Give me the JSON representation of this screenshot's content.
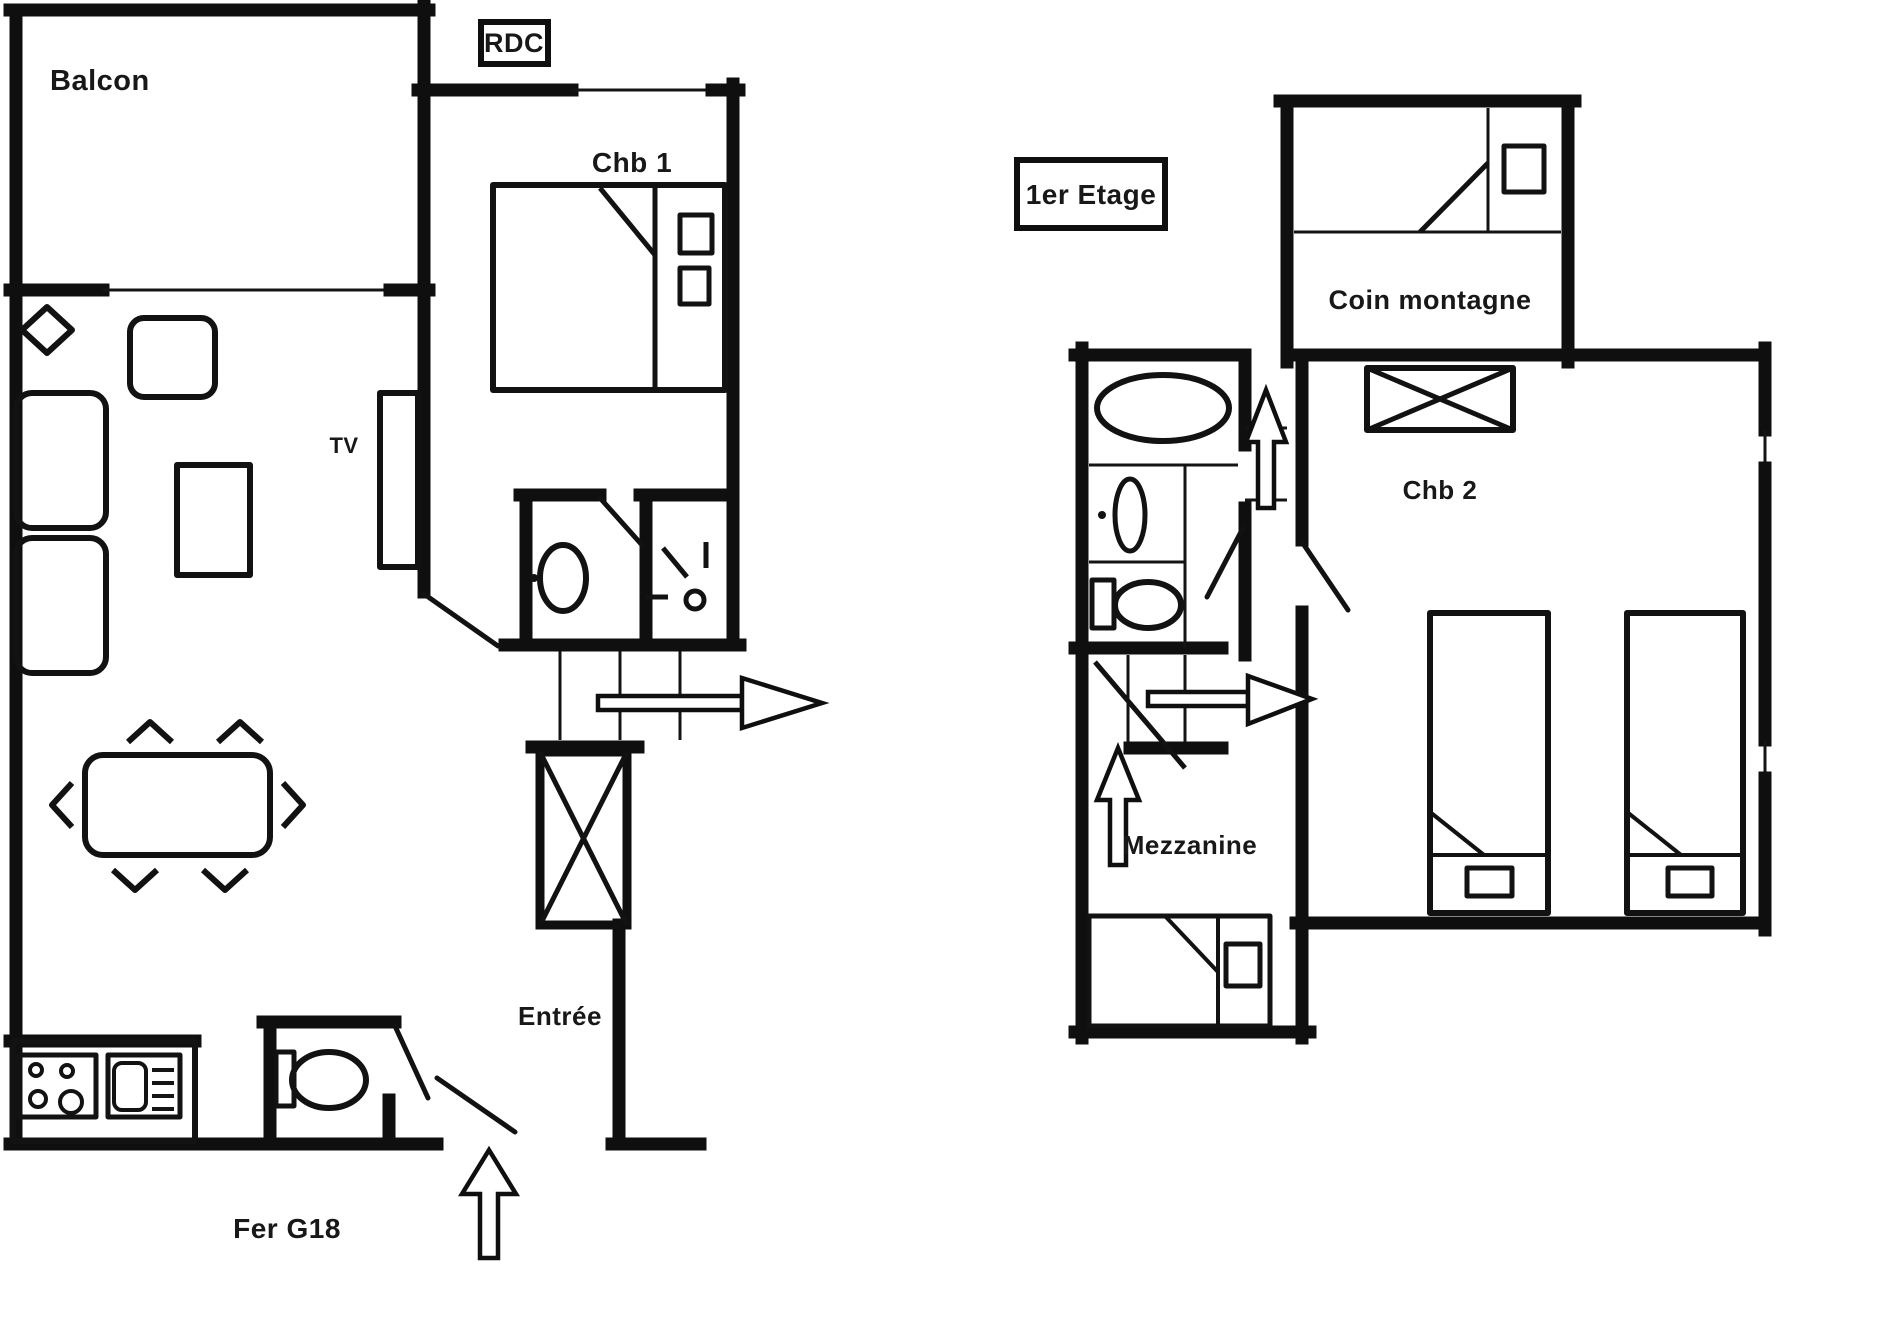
{
  "page": {
    "type": "floor-plan",
    "background": "#ffffff",
    "line_color": "#0f0f0f"
  },
  "labels": {
    "balcon": "Balcon",
    "rdc": "RDC",
    "chb1": "Chb 1",
    "tv": "TV",
    "entree": "Entrée",
    "fer_g18": "Fer G18",
    "etage1": "1er Etage",
    "coin_montagne": "Coin montagne",
    "chb2": "Chb 2",
    "mezzanine": "Mezzanine"
  },
  "floors": [
    {
      "name": "RDC",
      "label_key": "rdc",
      "rooms": [
        {
          "label": "Balcon",
          "type": "balcony"
        },
        {
          "label": "Chb 1",
          "type": "bedroom",
          "furniture": [
            "double-bed",
            "two-pillows",
            "tv"
          ]
        },
        {
          "type": "wc",
          "furniture": [
            "toilet"
          ]
        },
        {
          "type": "shower-room",
          "furniture": [
            "shower"
          ]
        },
        {
          "type": "living-dining",
          "furniture": [
            "armchair",
            "sofa",
            "sofa",
            "coffee-table",
            "dining-table",
            "six-chairs"
          ]
        },
        {
          "type": "kitchen",
          "furniture": [
            "stove-4-burners",
            "sink"
          ]
        },
        {
          "label": "Entrée",
          "type": "entrance",
          "furniture": [
            "toilet",
            "entry-arrow",
            "stairs-up-arrow",
            "shaft-cross-box"
          ]
        }
      ]
    },
    {
      "name": "1er Etage",
      "label_key": "etage1",
      "rooms": [
        {
          "label": "Coin montagne",
          "type": "sleeping-nook",
          "furniture": [
            "bed",
            "pillow"
          ]
        },
        {
          "label": "Chb 2",
          "type": "bedroom",
          "furniture": [
            "crossed-wardrobe",
            "single-bed",
            "single-bed"
          ]
        },
        {
          "label": "Mezzanine",
          "type": "mezzanine",
          "furniture": [
            "bed",
            "stairs",
            "up-arrow",
            "right-arrow"
          ]
        },
        {
          "type": "bathroom",
          "furniture": [
            "bathtub",
            "washbasin",
            "toilet"
          ]
        }
      ]
    }
  ],
  "annotations": {
    "apartment_code": "Fer G18"
  }
}
